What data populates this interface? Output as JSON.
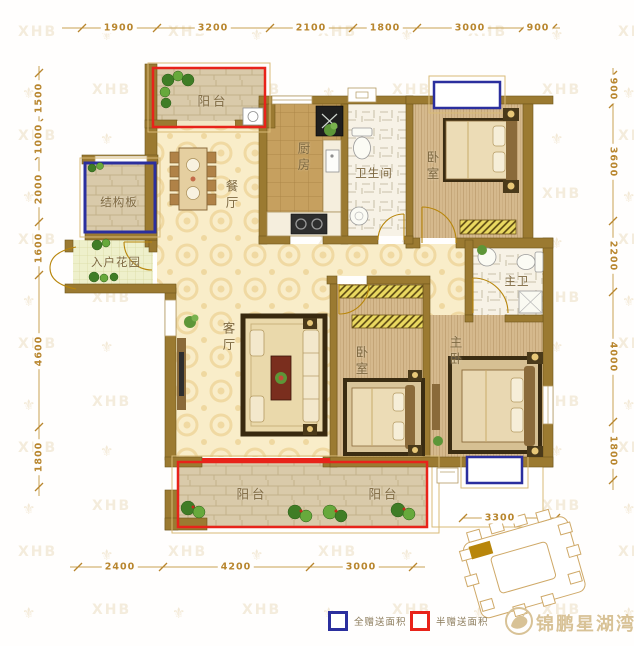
{
  "watermark": {
    "text": "XHB",
    "symbol": "⚜"
  },
  "dimensions": {
    "top": [
      "1900",
      "3200",
      "2100",
      "1800",
      "3000",
      "900"
    ],
    "left": [
      "1500",
      "1000",
      "2000",
      "1600",
      "4600",
      "1800"
    ],
    "right": [
      "900",
      "3600",
      "2200",
      "4000",
      "1800"
    ],
    "bottom": [
      "2400",
      "4200",
      "3000"
    ],
    "offset_right": "3300"
  },
  "rooms": {
    "balcony_top": "阳台",
    "structural_slab": "结构板",
    "entry_garden": "入户花园",
    "dining": "餐厅",
    "kitchen": "厨房",
    "bathroom": "卫生间",
    "bedroom_top": "卧室",
    "master_bath": "主卫",
    "living": "客厅",
    "bedroom_mid": "卧室",
    "master_bedroom": "主卧",
    "balcony_bottom_left": "阳台",
    "balcony_bottom_right": "阳台"
  },
  "legend": {
    "full_gift": {
      "label": "全赠送面积",
      "color": "#2b2f9e"
    },
    "half_gift": {
      "label": "半赠送面积",
      "color": "#e8231a"
    }
  },
  "brand": {
    "name": "锦鹏星湖湾",
    "color": "#d8c296"
  },
  "colors": {
    "wall": "#9b7a31",
    "dimension_text": "#b8862e",
    "accent_red": "#e8231a",
    "accent_blue": "#2b2f9e"
  }
}
